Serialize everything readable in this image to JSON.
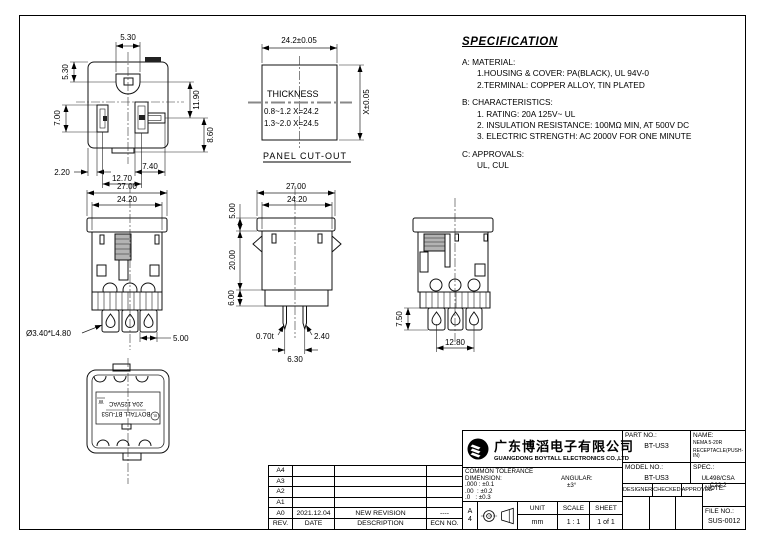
{
  "spec": {
    "title": "SPECIFICATION",
    "lines": [
      "A: MATERIAL:",
      "1.HOUSING & COVER: PA(BLACK), UL 94V-0",
      "2.TERMINAL: COPPER ALLOY, TIN PLATED",
      "B: CHARACTERISTICS:",
      "1. RATING: 20A 125V~ UL",
      "2. INSULATION RESISTANCE: 100MΩ MIN, AT 500V DC",
      "3. ELECTRIC STRENGTH: AC 2000V FOR ONE MINUTE",
      "C: APPROVALS:",
      "UL, CUL"
    ]
  },
  "views": {
    "face": {
      "top": "5.30",
      "left_top": "5.30",
      "right_upper": "11.90",
      "left": "7.00",
      "right_lower": "8.60",
      "bottom_left": "2.20",
      "bottom_mid": "7.40",
      "bottom": "12.70"
    },
    "cutout": {
      "width": "24.2±0.05",
      "height": "X±0.05",
      "thickness_title": "THICKNESS",
      "thickness_row1": "0.8~1.2 X=24.2",
      "thickness_row2": "1.3~2.0 X=24.5",
      "caption": "PANEL CUT-OUT"
    },
    "front": {
      "width_outer": "27.00",
      "width_inner": "24.20",
      "terminal_hole": "Ø3.40*L4.80",
      "terminal_width": "5.00"
    },
    "side": {
      "width_outer": "27.00",
      "width_inner": "24.20",
      "flange_height": "5.00",
      "body_height": "20.00",
      "base_height": "6.00",
      "pin_thickness": "0.70t",
      "pin_width": "2.40",
      "pin_pitch": "6.30"
    },
    "rear": {
      "terminal_length": "7.50",
      "terminal_pitch": "12.80"
    },
    "back": {
      "marking_line1": "BOYTALL BT-US3",
      "marking_line2": "20A 125VAC",
      "ul_mark": "UL",
      "w_mark": "W"
    }
  },
  "revision_table": {
    "headers": {
      "rev": "REV.",
      "date": "DATE",
      "description": "DESCRIPTION",
      "ecn": "ECN NO."
    },
    "rows": [
      {
        "rev": "A4",
        "date": "",
        "description": "",
        "ecn": ""
      },
      {
        "rev": "A3",
        "date": "",
        "description": "",
        "ecn": ""
      },
      {
        "rev": "A2",
        "date": "",
        "description": "",
        "ecn": ""
      },
      {
        "rev": "A1",
        "date": "",
        "description": "",
        "ecn": ""
      },
      {
        "rev": "A0",
        "date": "2021.12.04",
        "description": "NEW REVISION",
        "ecn": "----"
      }
    ]
  },
  "title_block": {
    "company_cn": "广东博滔电子有限公司",
    "company_en": "GUANGDONG BOYTALL ELECTRONICS CO.,LTD",
    "part_no_label": "PART NO.:",
    "part_no": "BT-US3",
    "model_no_label": "MODEL NO.:",
    "model_no": "BT-US3",
    "name_label": "NAME:",
    "name_line1": "NEMA 5-20R",
    "name_line2": "RECEPTACLE(PUSH-IN)",
    "spec_label": "SPEC.:",
    "spec_value": "UL498/CSA C22.2",
    "designer_label": "DESIGNER",
    "checked_label": "CHECKED",
    "approved_label": "APPROVED",
    "note_label": "NOTE:",
    "file_no_label": "FILE NO.:",
    "file_no": "SUS-0012",
    "tolerance_title": "COMMON TOLERANCE",
    "dimension_label": "DIMENSION:",
    "angular_label": "ANGULAR:",
    "tol_row1": ".000 : ±0.1",
    "tol_row2": ".00  : ±0.2",
    "tol_row3": ".0   : ±0.3",
    "angular_value": "±3°",
    "paper_size_line1": "A",
    "paper_size_line2": "4",
    "unit_label": "UNIT",
    "unit_value": "mm",
    "scale_label": "SCALE",
    "scale_value": "1 : 1",
    "sheet_label": "SHEET",
    "sheet_value": "1 of 1"
  }
}
